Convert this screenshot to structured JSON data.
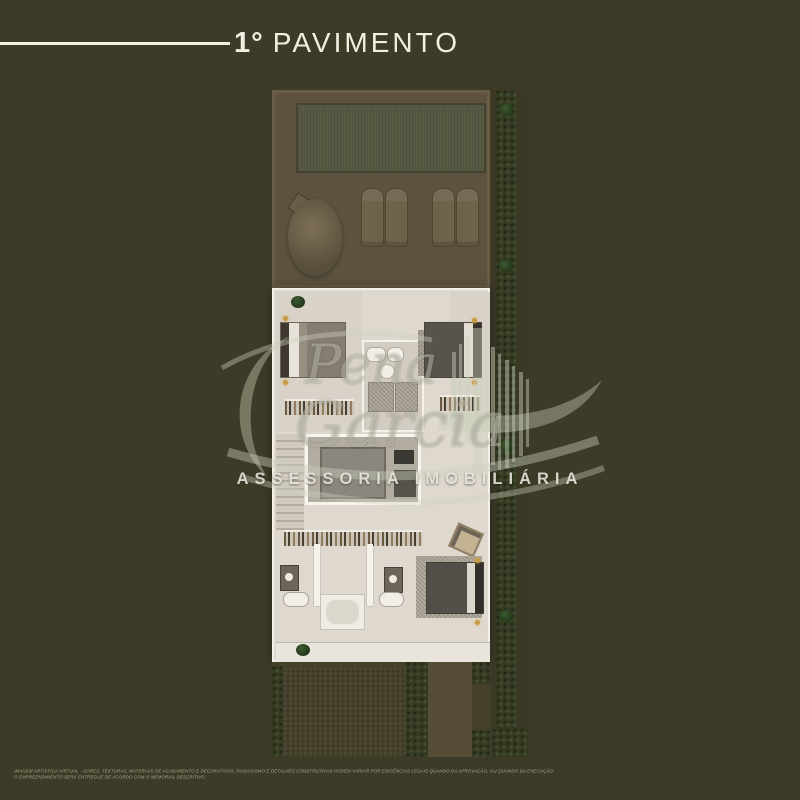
{
  "header": {
    "title_number": "1°",
    "title_word": "PAVIMENTO"
  },
  "watermark": {
    "script_top": "Pena",
    "script_bottom": "Garcia",
    "subtitle": "ASSESSORIA IMOBILIÁRIA"
  },
  "disclaimer": {
    "line1": "IMAGEM ARTÍSTICA VIRTUAL - CORES, TEXTURAS, MATERIAIS DE ACABAMENTO E DECORATIVOS, PAISAGISMO E DETALHES CONSTRUTIVOS PODEM VARIAR POR EXIGÊNCIAS LEGAIS QUANDO DA APROVAÇÃO, OU QUANDO DA EXECUÇÃO.",
    "line2": "O EMPREENDIMENTO SERÁ ENTREGUE  DE ACORDO COM O MEMORIAL DESCRITIVO."
  },
  "plan": {
    "depicted_features": [
      "rear-terrace-deck",
      "pool-lawn-panel",
      "sun-lounger x4",
      "parasol-with-side-table",
      "bedroom-upper-left-with-bed-and-wardrobe",
      "bedroom-upper-right-with-bed-and-wardrobe",
      "central-bathroom-block-sinks-toilet-showers",
      "staircase",
      "void-over-living-room",
      "corridor-wardrobe",
      "bathroom-lower-left",
      "bathroom-lower-center-with-bathtub",
      "bedroom-lower-right-with-armchair",
      "rear-porch-with-plant",
      "front-garden-lawn",
      "garden-hedges",
      "garden-path",
      "side-yard-hedge-with-plants"
    ]
  },
  "colors": {
    "background": "#3d3a27",
    "title_text": "#f1eee2",
    "plan_interior": "#ded8cf",
    "terrace": "#5c523e",
    "pool_panel": "#585942",
    "garden": "#454128",
    "hedge": "#353b23",
    "path": "#564d37",
    "lamp_gold": "#c79a44",
    "watermark": "rgba(225,228,213,0.40)"
  }
}
